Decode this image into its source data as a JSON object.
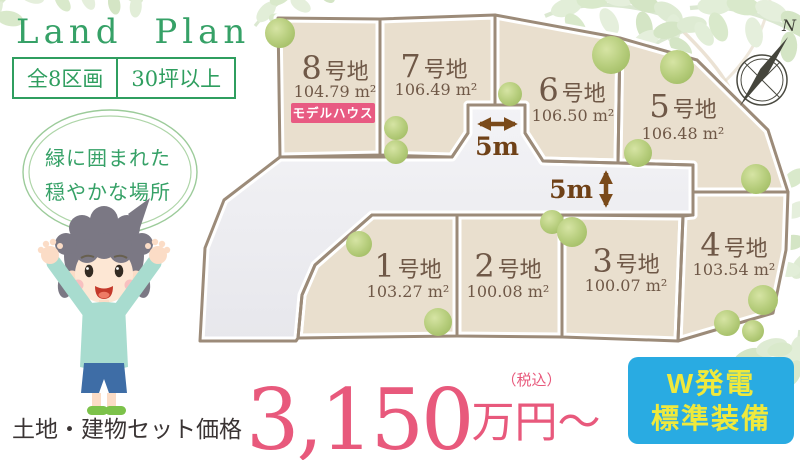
{
  "header": {
    "title": "Land Plan",
    "badges": [
      "全8区画",
      "30坪以上"
    ]
  },
  "intro_circle": {
    "line1": "緑に囲まれた",
    "line2": "穏やかな場所"
  },
  "map": {
    "north_label": "N",
    "model_house_label": "モデルハウス",
    "road_labels": [
      "5m",
      "5m"
    ],
    "plots": [
      {
        "num": "1",
        "suffix": "号地",
        "area": "103.27 m²"
      },
      {
        "num": "2",
        "suffix": "号地",
        "area": "100.08 m²"
      },
      {
        "num": "3",
        "suffix": "号地",
        "area": "100.07 m²"
      },
      {
        "num": "4",
        "suffix": "号地",
        "area": "103.54 m²"
      },
      {
        "num": "5",
        "suffix": "号地",
        "area": "106.48 m²"
      },
      {
        "num": "6",
        "suffix": "号地",
        "area": "106.50 m²"
      },
      {
        "num": "7",
        "suffix": "号地",
        "area": "106.49 m²"
      },
      {
        "num": "8",
        "suffix": "号地",
        "area": "104.79 m²"
      }
    ]
  },
  "price": {
    "prefix": "土地・建物セット価格",
    "amount": "3,150",
    "tax_note": "（税込）",
    "unit": "万円〜"
  },
  "feature_box": {
    "line1": "W発電",
    "line2": "標準装備"
  },
  "colors": {
    "accent_green": "#36a167",
    "price_pink": "#e8597c",
    "model_house_pink": "#e85a82",
    "feature_blue": "#29abe2",
    "feature_text_yellow": "#efe93d",
    "plot_fill": "#e9dfce",
    "road_fill": "#ededf0",
    "border_taupe": "#9c8b79",
    "plot_text_brown": "#6f5847",
    "dimension_brown": "#6f4117"
  }
}
